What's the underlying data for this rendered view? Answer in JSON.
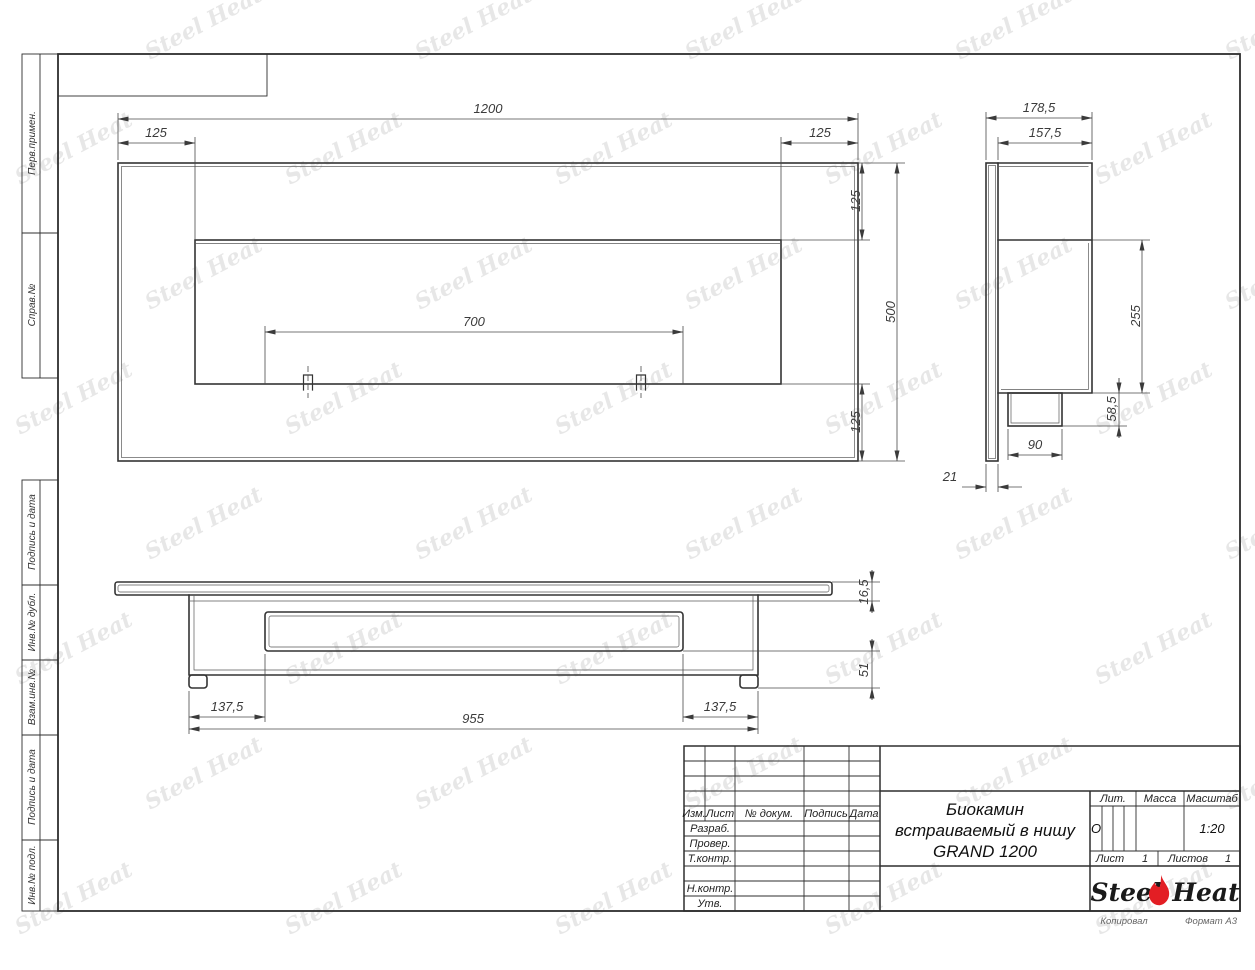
{
  "sheet": {
    "sidebar_labels": [
      "Перв.примен.",
      "Справ.№",
      "Подпись и дата",
      "Инв.№ дубл.",
      "Взам.инв.№",
      "Подпись и дата",
      "Инв.№ подл."
    ],
    "footer": {
      "kopiroval": "Копировал",
      "format": "Формат А3"
    }
  },
  "watermark": {
    "text": "Steel Heat",
    "color": "#e7e7e7"
  },
  "drawing": {
    "front_view": {
      "dims": {
        "width": "1200",
        "border_left": "125",
        "border_right": "125",
        "border_top": "125",
        "border_bottom": "125",
        "height": "500",
        "slot_width": "700"
      }
    },
    "side_view": {
      "dims": {
        "depth_overall": "178,5",
        "depth_inner": "157,5",
        "box_height": "255",
        "burner_height": "58,5",
        "burner_width": "90",
        "panel_thickness": "21"
      }
    },
    "bottom_view": {
      "dims": {
        "inset_left": "137,5",
        "inset_right": "137,5",
        "body_width": "955",
        "panel_thickness": "16,5",
        "foot_height": "51"
      }
    }
  },
  "title_block": {
    "revision_headers": [
      "Изм.",
      "Лист",
      "№ докум.",
      "Подпись",
      "Дата"
    ],
    "signature_rows": [
      "Разраб.",
      "Провер.",
      "Т.контр.",
      "Н.контр.",
      "Утв."
    ],
    "title_lines": [
      "Биокамин",
      "встраиваемый в нишу",
      "GRAND 1200"
    ],
    "lit": {
      "label": "Лит.",
      "value": "О"
    },
    "massa": {
      "label": "Масса",
      "value": ""
    },
    "masshtab": {
      "label": "Масштаб",
      "value": "1:20"
    },
    "sheet_info": {
      "list_label": "Лист",
      "list_value": "1",
      "listov_label": "Листов",
      "listov_value": "1"
    },
    "logo": {
      "word1": "Steel",
      "word2": "Heat",
      "flame_color": "#e31e24"
    }
  }
}
